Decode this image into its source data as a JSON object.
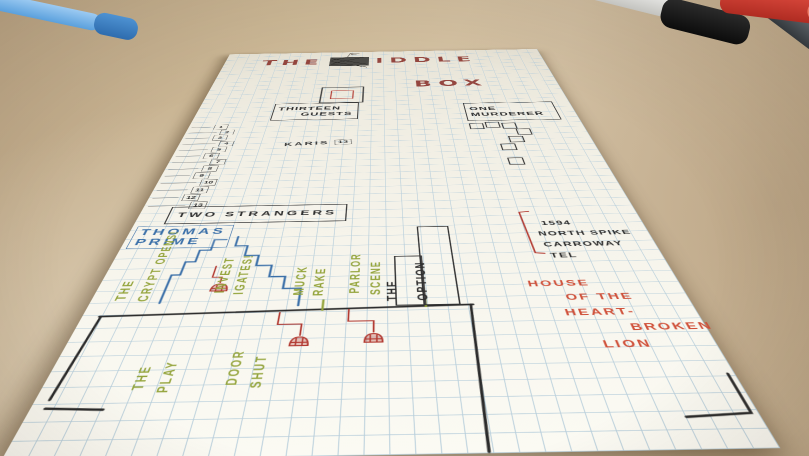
{
  "colors": {
    "title_red": "#8e3a33",
    "green_ink": "#94a43c",
    "blue_ink": "#3a6fa8",
    "red_ink": "#b23a32",
    "orange_ink": "#cf4f38",
    "black_ink": "#2e2e2e",
    "pencil": "#77736c"
  },
  "markers": {
    "sharpie_label": "Sharpie"
  },
  "paper": {
    "title": {
      "word1": "THE",
      "word2": "IDDLE",
      "word3": "BOX"
    },
    "header_left": {
      "line1": "THIRTEEN",
      "line2": "GUESTS"
    },
    "header_right": {
      "line1": "ONE",
      "line2": "MURDERER"
    },
    "karis": {
      "text": "KARIS",
      "number": "13"
    },
    "guest_list": {
      "numbers": [
        "1",
        "2",
        "3",
        "4",
        "5",
        "6",
        "7",
        "8",
        "9",
        "10",
        "11",
        "12",
        "13"
      ]
    },
    "two_strangers": "TWO STRANGERS",
    "thomas_prime": {
      "line1": "THOMAS",
      "line2": "PRIME"
    },
    "notes_green": {
      "crypt": {
        "col1": "THE",
        "col2": "CRYPT OPENS!"
      },
      "investigates": {
        "col1": "INVEST",
        "col2": "IGATES!"
      },
      "muck_rake": {
        "col1": "MUCK",
        "col2": "RAKE"
      },
      "parlor_scene": {
        "col1": "PARLOR",
        "col2": "SCENE"
      },
      "the_play": {
        "col1": "THE",
        "col2": "PLAY"
      },
      "door_shut": {
        "col1": "DOOR",
        "col2": "SHUT"
      }
    },
    "the_option": {
      "col1": "THE",
      "col2": "OPTION"
    },
    "address": {
      "line1": "1594",
      "line2": "NORTH SPIKE",
      "line3": "CARROWAY",
      "line4": "TEL"
    },
    "house": {
      "line1": "HOUSE",
      "line2": "OF THE",
      "line3": "HEART-",
      "line4": "BROKEN",
      "line5": "LION"
    }
  }
}
